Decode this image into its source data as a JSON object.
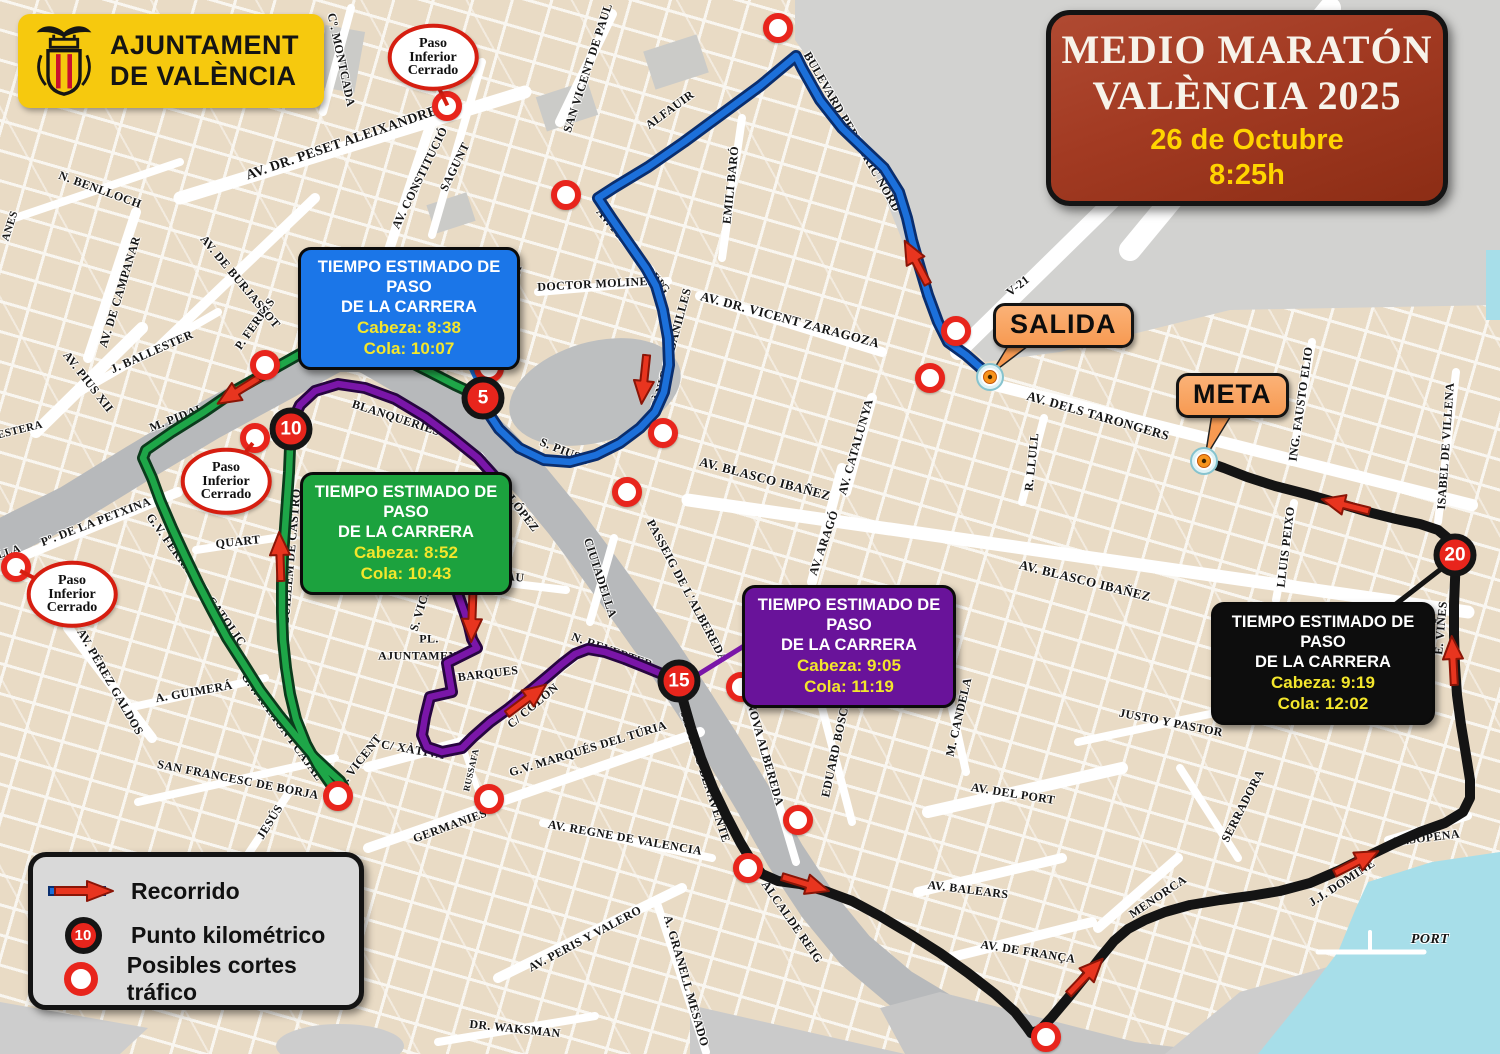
{
  "event": {
    "title_line1": "MEDIO MARATÓN",
    "title_line2": "VALÈNCIA 2025",
    "date": "26 de Octubre",
    "start_time": "8:25h"
  },
  "logo": {
    "name_line1": "AJUNTAMENT",
    "name_line2": "DE VALÈNCIA"
  },
  "legend": {
    "recorrido": "Recorrido",
    "punto": "Punto kilométrico",
    "punto_badge": "10",
    "cortes": "Posibles cortes tráfico"
  },
  "markers": {
    "start_label": "SALIDA",
    "finish_label": "META"
  },
  "colors": {
    "route_blue": "#1C70DA",
    "route_green": "#1EA648",
    "route_purple": "#7A16A8",
    "route_black": "#141414",
    "arrow_red": "#E8351F",
    "marker_red": "#E8251C",
    "water": "#A7DEE9",
    "accent_orange": "#F79A52",
    "title_bg": "#A23A22",
    "logo_bg": "#F6C90E"
  },
  "info_boxes": [
    {
      "title_line1": "TIEMPO ESTIMADO DE PASO",
      "title_line2": "DE LA CARRERA",
      "cabeza": "Cabeza: 8:38",
      "cola": "Cola: 10:07",
      "color": "#1B76E8",
      "x": 298,
      "y": 247,
      "w": 206
    },
    {
      "title_line1": "TIEMPO ESTIMADO DE PASO",
      "title_line2": "DE LA CARRERA",
      "cabeza": "Cabeza: 8:52",
      "cola": "Cola: 10:43",
      "color": "#1CA23E",
      "x": 300,
      "y": 472,
      "w": 196
    },
    {
      "title_line1": "TIEMPO ESTIMADO DE PASO",
      "title_line2": "DE LA CARRERA",
      "cabeza": "Cabeza: 9:05",
      "cola": "Cola: 11:19",
      "color": "#69139A",
      "x": 742,
      "y": 585,
      "w": 198
    },
    {
      "title_line1": "TIEMPO ESTIMADO DE PASO",
      "title_line2": "DE LA CARRERA",
      "cabeza": "Cabeza: 9:19",
      "cola": "Cola: 12:02",
      "color": "#0D0D0D",
      "x": 1211,
      "y": 602,
      "w": 208
    }
  ],
  "km_markers": [
    {
      "n": "5",
      "x": 483,
      "y": 398
    },
    {
      "n": "10",
      "x": 291,
      "y": 429
    },
    {
      "n": "15",
      "x": 679,
      "y": 681
    },
    {
      "n": "20",
      "x": 1455,
      "y": 555
    }
  ],
  "paso_ovals": [
    {
      "l1": "Paso",
      "l2": "Inferior",
      "l3": "Cerrado",
      "x": 433,
      "y": 57
    },
    {
      "l1": "Paso",
      "l2": "Inferior",
      "l3": "Cerrado",
      "x": 226,
      "y": 481
    },
    {
      "l1": "Paso",
      "l2": "Inferior",
      "l3": "Cerrado",
      "x": 72,
      "y": 594
    }
  ],
  "paso_connectors": [
    {
      "x": 436,
      "y": 80,
      "r": 64,
      "len": 26
    },
    {
      "x": 238,
      "y": 460,
      "r": -52,
      "len": 24
    },
    {
      "x": 46,
      "y": 582,
      "r": -153,
      "len": 29
    }
  ],
  "traffic_cuts": [
    {
      "x": 778,
      "y": 28
    },
    {
      "x": 566,
      "y": 195
    },
    {
      "x": 956,
      "y": 331
    },
    {
      "x": 930,
      "y": 378
    },
    {
      "x": 447,
      "y": 106
    },
    {
      "x": 265,
      "y": 365
    },
    {
      "x": 255,
      "y": 438
    },
    {
      "x": 16,
      "y": 567
    },
    {
      "x": 489,
      "y": 368
    },
    {
      "x": 663,
      "y": 433
    },
    {
      "x": 627,
      "y": 492
    },
    {
      "x": 741,
      "y": 687
    },
    {
      "x": 798,
      "y": 820
    },
    {
      "x": 748,
      "y": 868
    },
    {
      "x": 489,
      "y": 799
    },
    {
      "x": 338,
      "y": 796
    },
    {
      "x": 1046,
      "y": 1037
    }
  ],
  "arrows": [
    {
      "x": 916,
      "y": 262,
      "r": -118
    },
    {
      "x": 644,
      "y": 380,
      "r": 96
    },
    {
      "x": 238,
      "y": 391,
      "r": 148
    },
    {
      "x": 280,
      "y": 556,
      "r": -92
    },
    {
      "x": 472,
      "y": 618,
      "r": 92
    },
    {
      "x": 527,
      "y": 699,
      "r": -37
    },
    {
      "x": 806,
      "y": 884,
      "r": 17
    },
    {
      "x": 1086,
      "y": 976,
      "r": -46
    },
    {
      "x": 1357,
      "y": 862,
      "r": -27
    },
    {
      "x": 1453,
      "y": 660,
      "r": -93
    },
    {
      "x": 1345,
      "y": 505,
      "r": -166
    }
  ],
  "streets": [
    {
      "t": "Cº. MONTCADA",
      "x": 341,
      "y": 60,
      "r": 78
    },
    {
      "t": "AV. DR.  PESET  ALEIXANDRE",
      "x": 342,
      "y": 144,
      "r": -19,
      "fs": 14
    },
    {
      "t": "SAN VICENT DE PAUL",
      "x": 588,
      "y": 68,
      "r": -72
    },
    {
      "t": "ALFAUIR",
      "x": 670,
      "y": 110,
      "r": -36
    },
    {
      "t": "BULEVARD PERIFÉRIC NORD",
      "x": 852,
      "y": 132,
      "r": 60
    },
    {
      "t": "EMILI BARÓ",
      "x": 731,
      "y": 185,
      "r": -84
    },
    {
      "t": "AV. PRIMAT REIG",
      "x": 633,
      "y": 251,
      "r": 50
    },
    {
      "t": "DOCTOR MOLINELL",
      "x": 601,
      "y": 284,
      "r": -3
    },
    {
      "t": "ALMASSORA",
      "x": 511,
      "y": 302,
      "r": -78,
      "fs": 11
    },
    {
      "t": "BOTÀNIC CABANILLES",
      "x": 669,
      "y": 358,
      "r": -75
    },
    {
      "t": "AV. DR. VICENT ZARAGOZA",
      "x": 790,
      "y": 320,
      "r": 15,
      "fs": 13
    },
    {
      "t": "V-21",
      "x": 1018,
      "y": 286,
      "r": -38
    },
    {
      "t": "AV. DELS TARONGERS",
      "x": 1098,
      "y": 416,
      "r": 16,
      "fs": 13
    },
    {
      "t": "R. LLULL",
      "x": 1032,
      "y": 462,
      "r": -84
    },
    {
      "t": "ING. FAUSTO ELIO",
      "x": 1301,
      "y": 404,
      "r": -82
    },
    {
      "t": "ISABEL DE VILLENA",
      "x": 1446,
      "y": 446,
      "r": -86
    },
    {
      "t": "LLUIS PEIXO",
      "x": 1286,
      "y": 547,
      "r": -83
    },
    {
      "t": "E. VIÑES",
      "x": 1441,
      "y": 628,
      "r": -85
    },
    {
      "t": "AV. CATALUNYA",
      "x": 856,
      "y": 447,
      "r": -74
    },
    {
      "t": "AV. ARAGÓ",
      "x": 824,
      "y": 543,
      "r": -71
    },
    {
      "t": "AV. BLASCO IBAÑEZ",
      "x": 765,
      "y": 479,
      "r": 15,
      "fs": 13
    },
    {
      "t": "AV. BLASCO IBAÑEZ",
      "x": 1085,
      "y": 581,
      "r": 14,
      "fs": 13
    },
    {
      "t": "S. PIUS V",
      "x": 566,
      "y": 452,
      "r": 22
    },
    {
      "t": "PINTOR LÓPEZ",
      "x": 507,
      "y": 493,
      "r": 52
    },
    {
      "t": "CIUTADELLA",
      "x": 600,
      "y": 578,
      "r": 72
    },
    {
      "t": "PASSEIG DE L'ALBEREDA",
      "x": 687,
      "y": 591,
      "r": 62
    },
    {
      "t": "PAU",
      "x": 512,
      "y": 577,
      "r": 6
    },
    {
      "t": "N. REVERTER",
      "x": 612,
      "y": 651,
      "r": 20
    },
    {
      "t": "BLANQUERIES",
      "x": 396,
      "y": 418,
      "r": 18
    },
    {
      "t": "QUART",
      "x": 238,
      "y": 542,
      "r": -6
    },
    {
      "t": "GUILLEM DE CASTRO",
      "x": 291,
      "y": 557,
      "r": -85
    },
    {
      "t": "M. PIDAL",
      "x": 177,
      "y": 418,
      "r": -21
    },
    {
      "t": "J. BALLESTER",
      "x": 152,
      "y": 352,
      "r": -24
    },
    {
      "t": "P. FERRIS",
      "x": 255,
      "y": 324,
      "r": -55
    },
    {
      "t": "AV. DE BURJASSOT",
      "x": 240,
      "y": 282,
      "r": 50
    },
    {
      "t": "AV. DE CAMPANAR",
      "x": 120,
      "y": 292,
      "r": -73
    },
    {
      "t": "N. BENLLOCH",
      "x": 100,
      "y": 190,
      "r": 20
    },
    {
      "t": "AV. CONSTITUCIÓ",
      "x": 420,
      "y": 178,
      "r": -64
    },
    {
      "t": "SAGUNT",
      "x": 455,
      "y": 167,
      "r": -64
    },
    {
      "t": "AV. PIUS XII",
      "x": 88,
      "y": 382,
      "r": 52
    },
    {
      "t": "Pº. DE LA PETXINA",
      "x": 96,
      "y": 522,
      "r": -21
    },
    {
      "t": "G.V. FERRAN EL CATOLIC",
      "x": 196,
      "y": 580,
      "r": 54
    },
    {
      "t": "AV. PÉREZ GALDOS",
      "x": 110,
      "y": 682,
      "r": 60
    },
    {
      "t": "A. GUIMERÁ",
      "x": 194,
      "y": 692,
      "r": -10
    },
    {
      "t": "G.V. RAMÓN I CAJAL",
      "x": 282,
      "y": 727,
      "r": 54
    },
    {
      "t": "SAN FRANCESC DE BORJA",
      "x": 238,
      "y": 780,
      "r": 11
    },
    {
      "t": "JESÚS",
      "x": 270,
      "y": 822,
      "r": -58
    },
    {
      "t": "S. VICENT",
      "x": 423,
      "y": 601,
      "r": -73
    },
    {
      "t": "S. VICENT",
      "x": 360,
      "y": 761,
      "r": -52
    },
    {
      "t": "PL.",
      "x": 429,
      "y": 639,
      "r": 0
    },
    {
      "t": "AJUNTAMENT",
      "x": 422,
      "y": 656,
      "r": 0
    },
    {
      "t": "BARQUES",
      "x": 488,
      "y": 674,
      "r": -7
    },
    {
      "t": "C/ XÀTIVA",
      "x": 413,
      "y": 750,
      "r": 10
    },
    {
      "t": "RUSSAFA",
      "x": 471,
      "y": 770,
      "r": -77,
      "fs": 9
    },
    {
      "t": "C/ COLÓN",
      "x": 533,
      "y": 706,
      "r": -40
    },
    {
      "t": "GERMANIES",
      "x": 450,
      "y": 826,
      "r": -20
    },
    {
      "t": "G.V. MARQUÉS DEL TÚRIA",
      "x": 588,
      "y": 749,
      "r": -17
    },
    {
      "t": "AV. REGNE DE VALENCIA",
      "x": 625,
      "y": 838,
      "r": 10
    },
    {
      "t": "AV. PERIS Y VALERO",
      "x": 585,
      "y": 939,
      "r": -28
    },
    {
      "t": "A. GRANELL MESADO",
      "x": 686,
      "y": 981,
      "r": 74
    },
    {
      "t": "DR. WAKSMAN",
      "x": 515,
      "y": 1029,
      "r": 6
    },
    {
      "t": "JACINTO BENAVENTE",
      "x": 705,
      "y": 777,
      "r": 72
    },
    {
      "t": "NOVA ALBEREDA",
      "x": 765,
      "y": 754,
      "r": 74
    },
    {
      "t": "EDUARD BOSCÀ",
      "x": 836,
      "y": 748,
      "r": -78
    },
    {
      "t": "M. CANDELA",
      "x": 959,
      "y": 717,
      "r": -77
    },
    {
      "t": "AV. DEL PORT",
      "x": 1013,
      "y": 794,
      "r": 9
    },
    {
      "t": "ALCALDE REIG",
      "x": 792,
      "y": 922,
      "r": 55
    },
    {
      "t": "JUSTO Y PASTOR",
      "x": 1171,
      "y": 723,
      "r": 11
    },
    {
      "t": "SERRADORA",
      "x": 1243,
      "y": 806,
      "r": -63
    },
    {
      "t": "AV. BALEARS",
      "x": 968,
      "y": 890,
      "r": 7
    },
    {
      "t": "AV. DE FRANÇA",
      "x": 1028,
      "y": 952,
      "r": 9
    },
    {
      "t": "MENORCA",
      "x": 1158,
      "y": 897,
      "r": -34
    },
    {
      "t": "J.J. DOMINE",
      "x": 1342,
      "y": 883,
      "r": -33
    },
    {
      "t": "M.SOPENA",
      "x": 1427,
      "y": 838,
      "r": -7
    },
    {
      "t": "PORT",
      "x": 1430,
      "y": 940,
      "r": 0,
      "fs": 14,
      "it": 1
    },
    {
      "t": "ANES",
      "x": 10,
      "y": 226,
      "r": -72,
      "fs": 11
    },
    {
      "t": "ESTERA",
      "x": 20,
      "y": 430,
      "r": -14,
      "fs": 11
    },
    {
      "t": "LLA",
      "x": 9,
      "y": 552,
      "r": -18,
      "fs": 11
    }
  ]
}
